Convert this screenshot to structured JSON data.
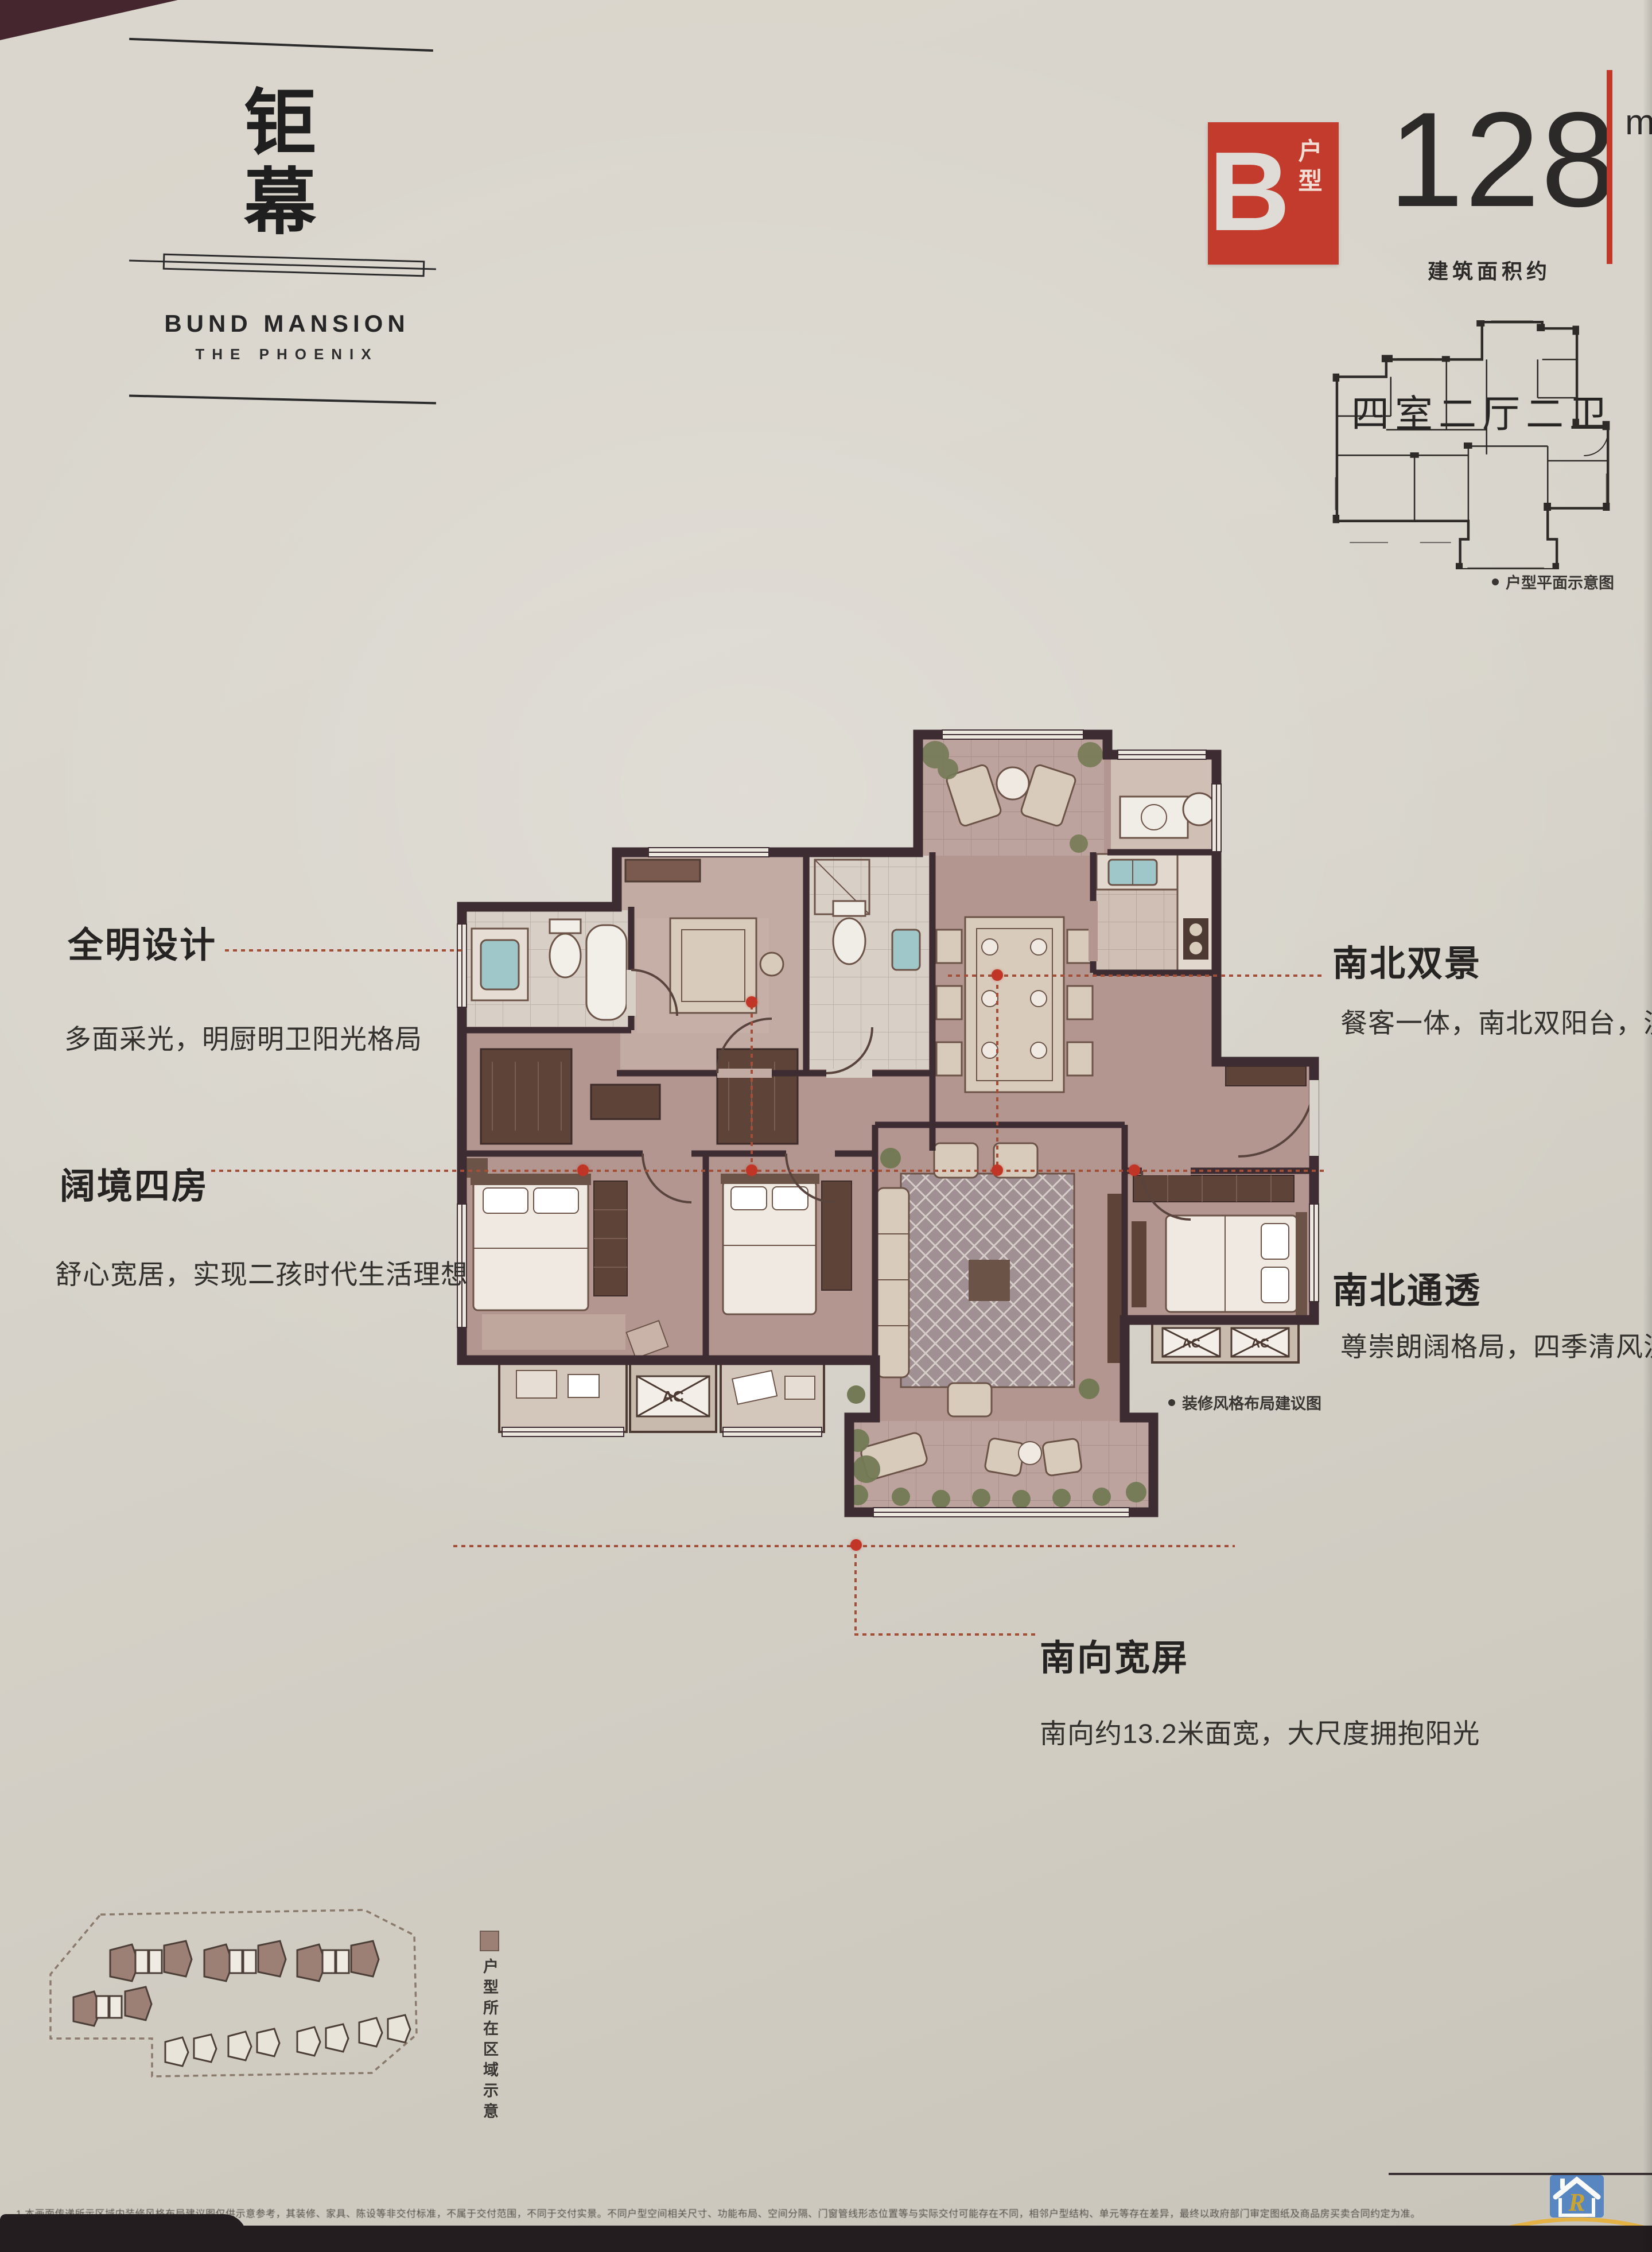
{
  "brand": {
    "chars": [
      "钜",
      "幕"
    ],
    "name_en": "BUND MANSION",
    "tagline_en": "THE PHOENIX"
  },
  "unit": {
    "badge_letter": "B",
    "badge_suffix": "户型",
    "area_value": "128",
    "area_unit": "m²",
    "area_label": "建筑面积约",
    "layout_summary": "四室二厅二卫",
    "mini_plan_caption": "户型平面示意图"
  },
  "features": [
    {
      "title": "全明设计",
      "desc": "多面采光，明厨明卫阳光格局"
    },
    {
      "title": "阔境四房",
      "desc": "舒心宽居，实现二孩时代生活理想"
    },
    {
      "title": "南北双景",
      "desc": "餐客一体，南北双阳台，漫享自"
    },
    {
      "title": "南北通透",
      "desc": "尊崇朗阔格局，四季清风流连"
    },
    {
      "title": "南向宽屏",
      "desc": "南向约13.2米面宽，大尺度拥抱阳光"
    }
  ],
  "plan": {
    "caption": "装修风格布局建议图",
    "ac_label": "AC"
  },
  "site": {
    "caption": "户型所在区域示意"
  },
  "footer": {
    "disclaimer": "1.本画面传递所示区域内装修风格布局建议图仅供示意参考，其装修、家具、陈设等非交付标准，不属于交付范围，不同于交付实景。不同户型空间相关尺寸、功能布局、空间分隔、门窗管线形态位置等与实际交付可能存在不同，相邻户型结构、单元等存在差异，最终以政府部门审定图纸及商品房买卖合同约定为准。"
  },
  "watermark": {
    "name": "瑞安房网",
    "url": "WWW.RuianFang.Com",
    "tagline": "瑞安房地产门户网站",
    "monogram": "R"
  },
  "colors": {
    "accent_red": "#c23b2c",
    "leader_red": "#a24e38",
    "paper": "#d8d4cb",
    "wall": "#3d2c32",
    "floor": "#b79c98"
  }
}
